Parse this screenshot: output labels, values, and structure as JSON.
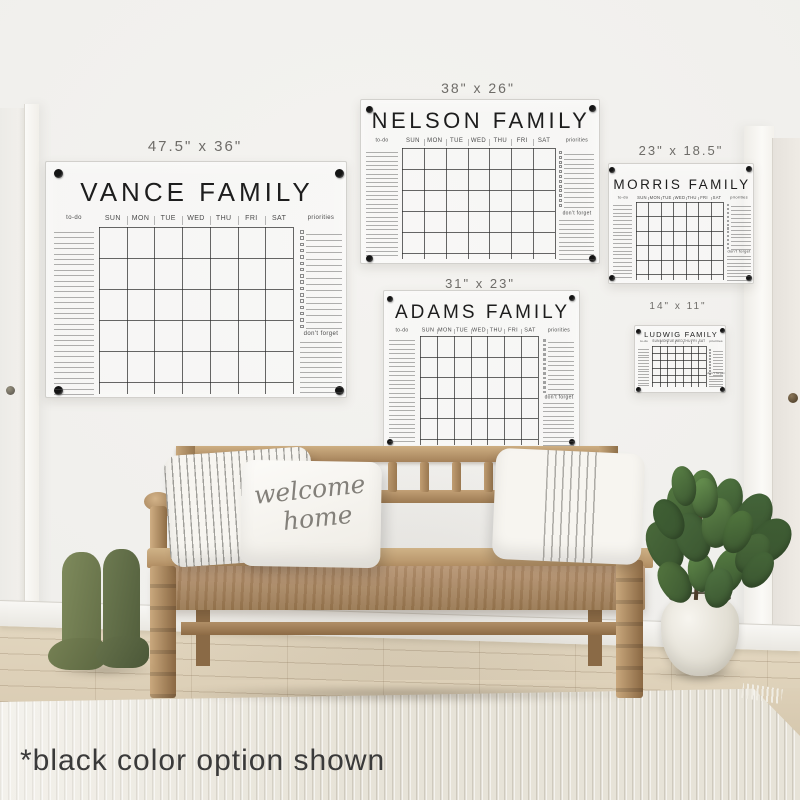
{
  "footnote": "*black color option shown",
  "days": [
    "SUN",
    "MON",
    "TUE",
    "WED",
    "THU",
    "FRI",
    "SAT"
  ],
  "section_labels": {
    "todo": "to-do",
    "priorities": "priorities",
    "dont_forget": "don't forget"
  },
  "welcome_pillow": {
    "line1": "welcome",
    "line2": "home"
  },
  "colors": {
    "calendar_ink": "#1d1d1d",
    "size_label": "#6e6c68",
    "option_shown": "black"
  },
  "calendars": [
    {
      "key": "vance",
      "title": "VANCE FAMILY",
      "size_label": "47.5\" x 36\"",
      "geom": {
        "panel": [
          45,
          161,
          302,
          237
        ],
        "label": [
          195,
          138,
          15
        ],
        "title": [
          176,
          26,
          4
        ],
        "header": [
          214,
          7
        ],
        "underline": 226,
        "rows": 5,
        "grid": [
          98,
          292
        ],
        "grid_bottom": 381,
        "bottom": 393,
        "todo": [
          53,
          93,
          231,
          5.4
        ],
        "todo_fs": 6,
        "pri": [
          299,
          341,
          229,
          6.3,
          16
        ],
        "box": 3.5,
        "df": [
          330,
          341,
          5
        ],
        "dots": [
          [
            57,
            172
          ],
          [
            338,
            172
          ],
          [
            57,
            389
          ],
          [
            338,
            389
          ]
        ],
        "dot_r": 4.5
      }
    },
    {
      "key": "nelson",
      "title": "NELSON FAMILY",
      "size_label": "38\" x 26\"",
      "geom": {
        "panel": [
          360,
          99,
          240,
          165
        ],
        "label": [
          478,
          80,
          14
        ],
        "title": [
          107,
          22,
          3.5
        ],
        "header": [
          137,
          6
        ],
        "underline": 147,
        "rows": 5,
        "grid": [
          401,
          554
        ],
        "grid_bottom": 252,
        "bottom": 258,
        "todo": [
          365,
          397,
          151,
          4.3
        ],
        "todo_fs": 5,
        "pri": [
          558,
          593,
          150,
          4.8,
          12
        ],
        "box": 3,
        "df": [
          210,
          219,
          4.3
        ],
        "dots": [
          [
            368,
            108
          ],
          [
            591,
            107
          ],
          [
            368,
            257
          ],
          [
            591,
            257
          ]
        ],
        "dot_r": 3.5
      }
    },
    {
      "key": "adams",
      "title": "ADAMS FAMILY",
      "size_label": "31\" x 23\"",
      "geom": {
        "panel": [
          383,
          290,
          197,
          158
        ],
        "label": [
          480,
          276,
          13
        ],
        "title": [
          301,
          19,
          3
        ],
        "header": [
          327,
          5.5
        ],
        "underline": 335,
        "rows": 5,
        "grid": [
          419,
          537
        ],
        "grid_bottom": 438,
        "bottom": 444,
        "todo": [
          388,
          414,
          339,
          4.4
        ],
        "todo_fs": 5,
        "pri": [
          542,
          573,
          338,
          4.7,
          12
        ],
        "box": 2.8,
        "df": [
          394,
          402,
          4.2
        ],
        "dots": [
          [
            389,
            298
          ],
          [
            571,
            297
          ],
          [
            389,
            441
          ],
          [
            571,
            441
          ]
        ],
        "dot_r": 3
      }
    },
    {
      "key": "morris",
      "title": "MORRIS FAMILY",
      "size_label": "23\" x 18.5\"",
      "geom": {
        "panel": [
          608,
          163,
          146,
          121
        ],
        "label": [
          681,
          143,
          13
        ],
        "title": [
          176,
          13.5,
          2.5
        ],
        "header": [
          195,
          4.2
        ],
        "underline": 201,
        "rows": 5,
        "grid": [
          635,
          722
        ],
        "grid_bottom": 273,
        "bottom": 279,
        "todo": [
          612,
          631,
          204,
          3.8
        ],
        "todo_fs": 4,
        "pri": [
          726,
          750,
          203,
          3.9,
          12
        ],
        "box": 2.2,
        "df": [
          249,
          255,
          3.4
        ],
        "dots": [
          [
            611,
            169
          ],
          [
            748,
            168
          ],
          [
            611,
            277
          ],
          [
            748,
            277
          ]
        ],
        "dot_r": 3
      }
    },
    {
      "key": "ludwig",
      "title": "LUDWIG FAMILY",
      "size_label": "14\" x 11\"",
      "geom": {
        "panel": [
          634,
          325,
          92,
          68
        ],
        "label": [
          678,
          301,
          10
        ],
        "title": [
          329,
          7.5,
          1.2
        ],
        "header": [
          339,
          3.2
        ],
        "underline": 345,
        "rows": 5,
        "grid": [
          651,
          705
        ],
        "grid_bottom": 381,
        "bottom": 386,
        "todo": [
          637,
          648,
          348,
          2.8
        ],
        "todo_fs": 3,
        "pri": [
          708,
          722,
          348,
          3.0,
          9
        ],
        "box": 1.6,
        "df": [
          371,
          375,
          2.6
        ],
        "dots": [
          [
            637,
            330
          ],
          [
            721,
            329
          ],
          [
            637,
            388
          ],
          [
            721,
            388
          ]
        ],
        "dot_r": 2.5
      }
    }
  ]
}
